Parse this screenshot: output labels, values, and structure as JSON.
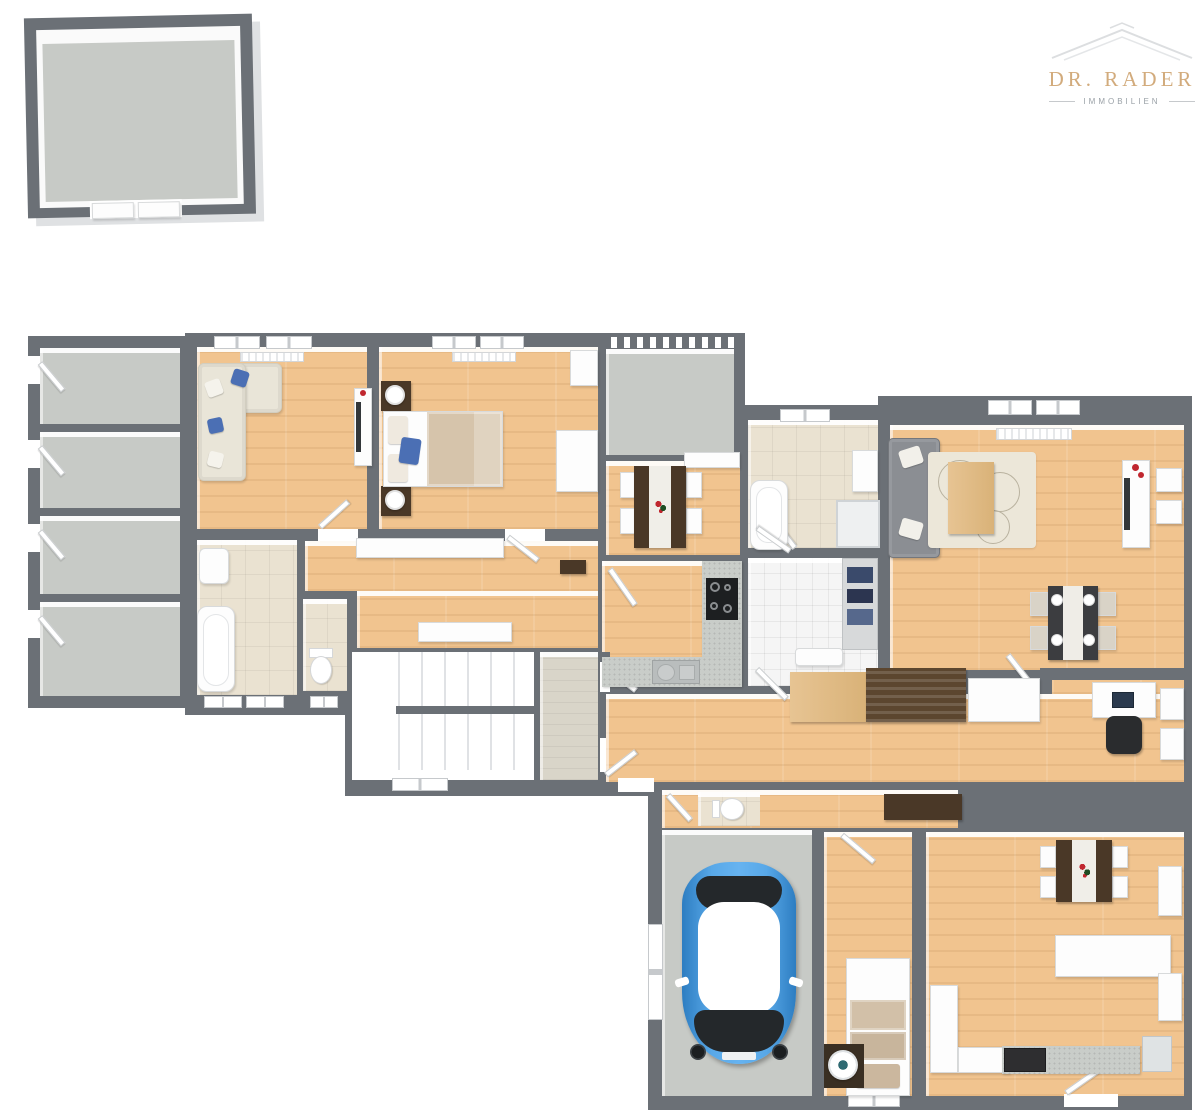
{
  "logo": {
    "title": "DR. RADER",
    "subtitle": "IMMOBILIEN"
  },
  "colors": {
    "wall": "#6b7076",
    "outer_face": "#dfe1e3",
    "floor_wood": "#f1c48f",
    "floor_concrete": "#c7cac6",
    "floor_tile_beige": "#eae2d1",
    "floor_tile_white": "#f5f5f5",
    "floor_entry": "#d9d5c9",
    "sofa_cream": "#e9e5d8",
    "sofa_gray": "#8b8e93",
    "pillow_blue": "#4b6fb4",
    "furn_white": "#fdfdfd",
    "furn_dark_wood": "#4a3827",
    "walnut": "#5c462f",
    "counter_gray": "#c9cdc9",
    "cooktop_black": "#1d1f21",
    "car_blue": "#3f93d8",
    "car_dark": "#24282b",
    "red_accent": "#c0272f",
    "rug": "#ece7d9",
    "logo_gold": "#d2ab7c",
    "logo_gray": "#9aa1a7",
    "roof_line": "#dcdee0"
  }
}
